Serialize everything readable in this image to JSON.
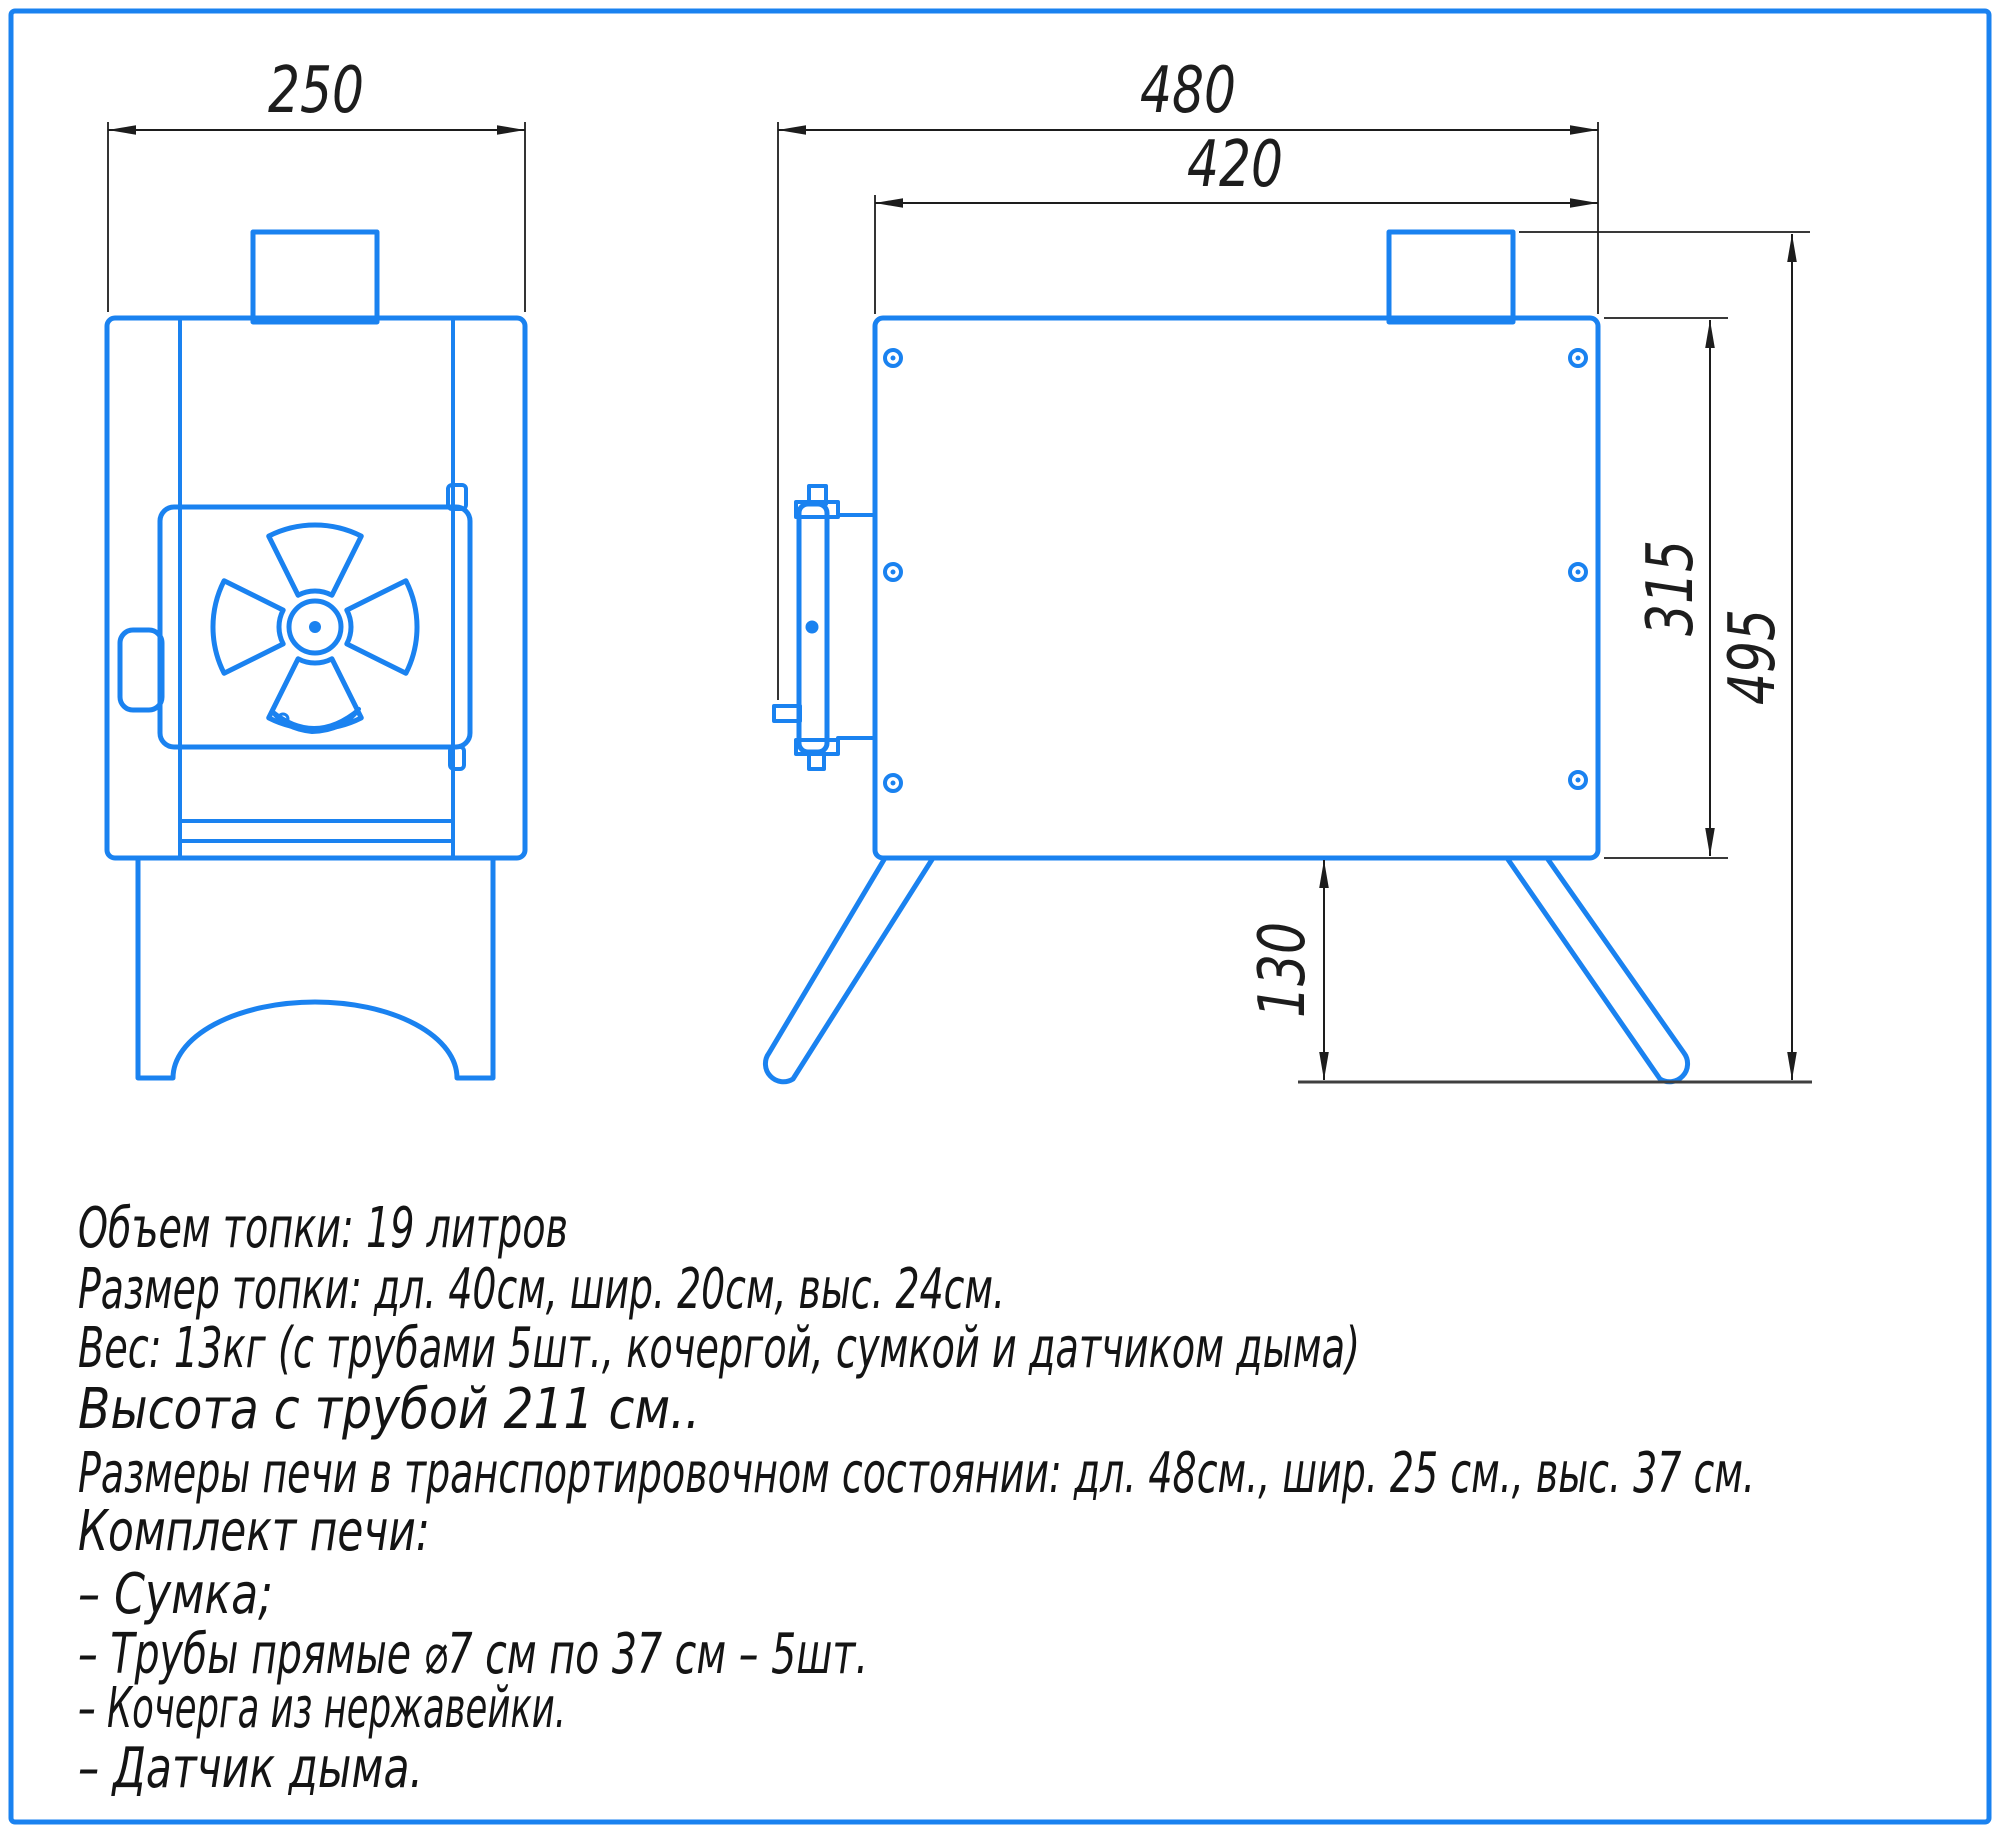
{
  "drawing": {
    "colors": {
      "line_blue": "#1a82f0",
      "dimension_dark": "#1d1d1d",
      "ground_gray": "#3f3f3f",
      "background": "#ffffff"
    },
    "dims": {
      "front_width": "250",
      "overall_length": "480",
      "body_length": "420",
      "body_height": "315",
      "overall_height": "495",
      "leg_height": "130"
    }
  },
  "specs": {
    "lines": [
      "Объем топки: 19 литров",
      "Размер топки: дл. 40см, шир. 20см, выс. 24см.",
      "Вес: 13кг (с трубами 5шт., кочергой, сумкой и датчиком дыма)",
      "Высота с трубой 211 см..",
      "Размеры печи в транспортировочном состоянии: дл. 48см., шир. 25 см., выс. 37 см.",
      "Комплект печи:",
      "– Сумка;",
      "– Трубы прямые ⌀7 см по 37 см – 5шт.",
      "– Кочерга из нержавейки.",
      "– Датчик дыма."
    ]
  }
}
